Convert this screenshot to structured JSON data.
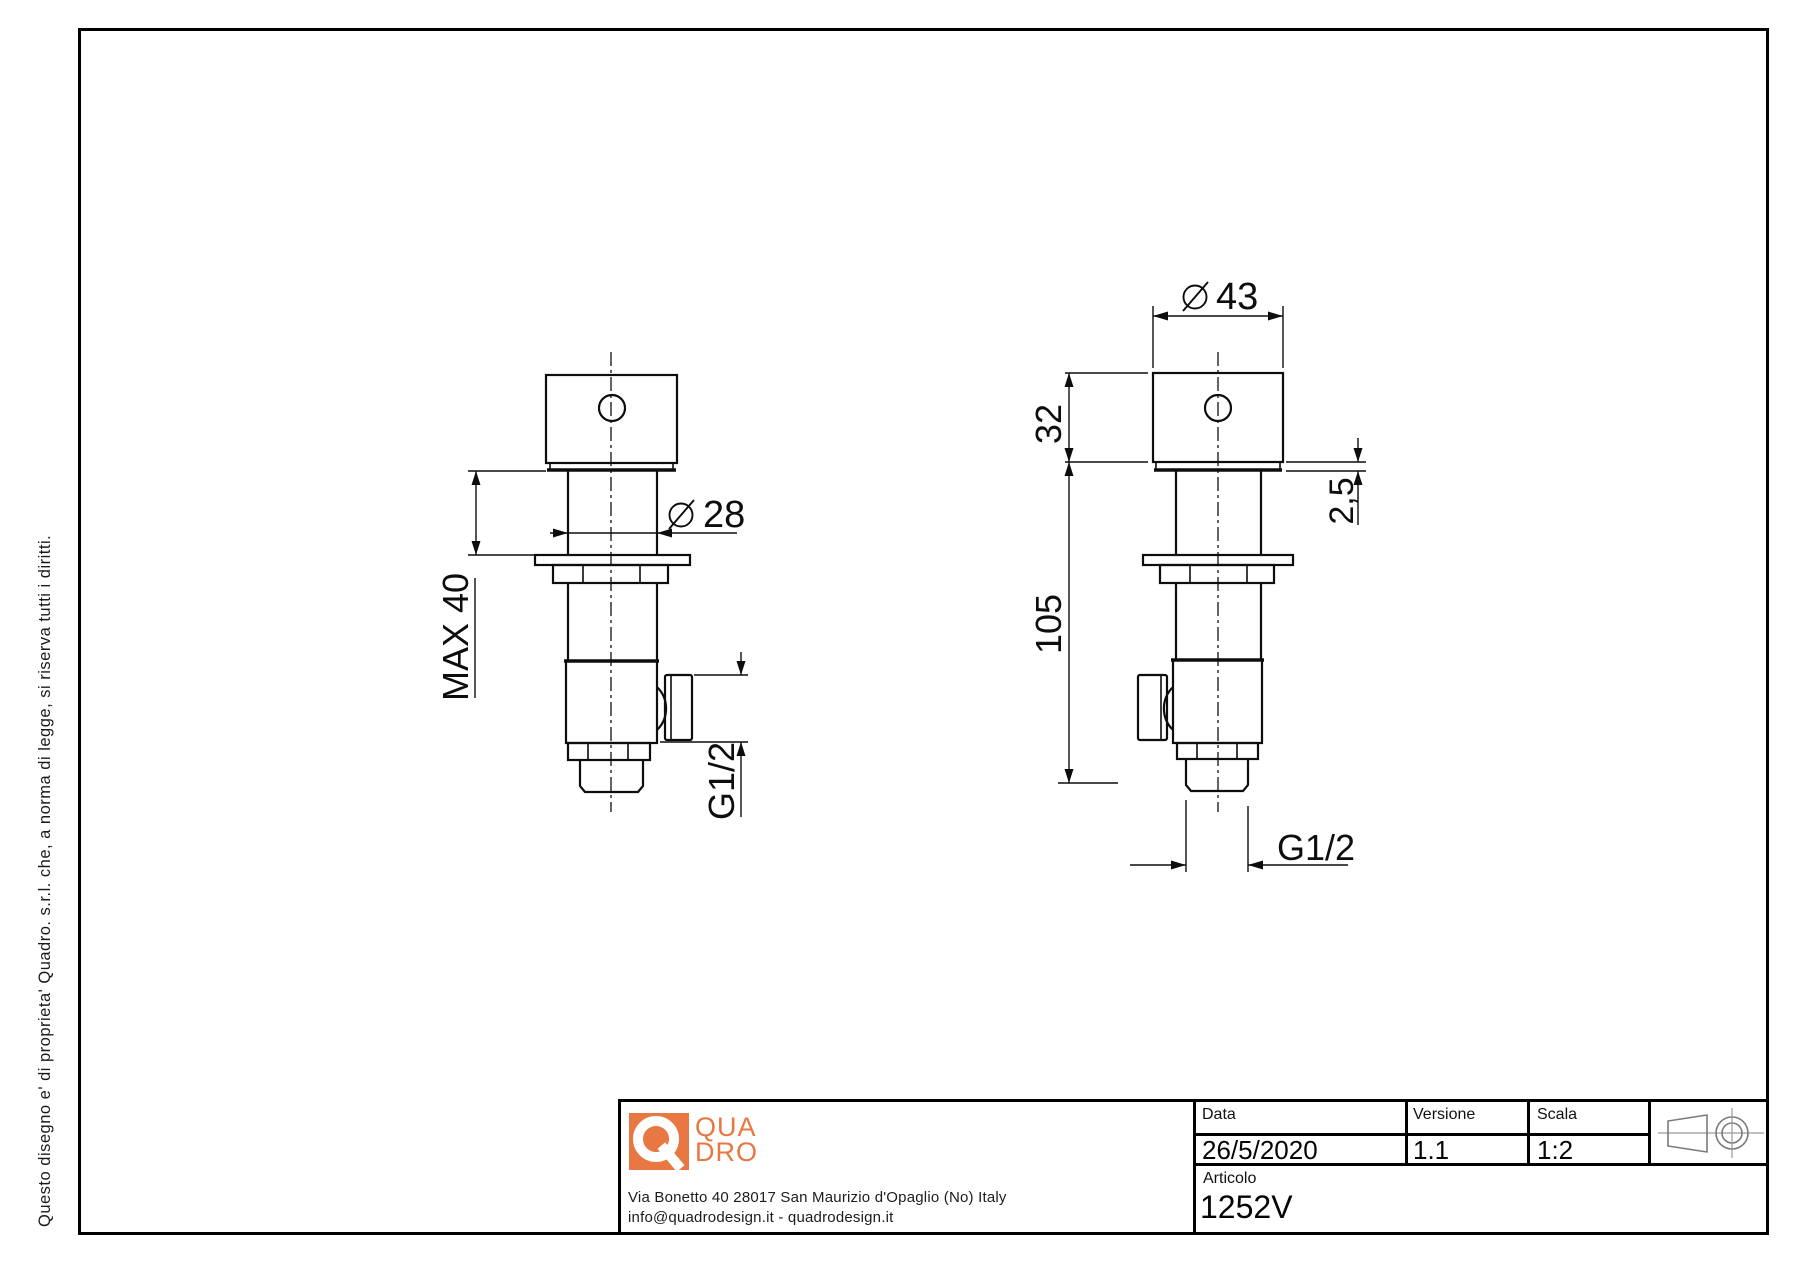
{
  "side_note": "Questo disegno e' di proprieta' Quadro. s.r.l. che, a norma di legge, si riserva tutti i diritti.",
  "figures": {
    "left_view": {
      "max_insertion": "MAX 40",
      "stem_diameter": {
        "symbol": "diameter",
        "value": "28"
      },
      "outlet_thread": "G1/2"
    },
    "right_view": {
      "handle_diameter": {
        "symbol": "diameter",
        "value": "43"
      },
      "handle_height": "32",
      "plate_thickness": "2,5",
      "body_height": "105",
      "tail_thread": "G1/2"
    }
  },
  "title_block": {
    "company": {
      "logo_line1": "QUA",
      "logo_line2": "DRO",
      "brand_color": "#e87741",
      "address_line1": "Via Bonetto 40  28017 San Maurizio d'Opaglio (No) Italy",
      "address_line2": "info@quadrodesign.it  -  quadrodesign.it"
    },
    "fields": {
      "data_label": "Data",
      "data_value": "26/5/2020",
      "versione_label": "Versione",
      "versione_value": "1.1",
      "scala_label": "Scala",
      "scala_value": "1:2",
      "articolo_label": "Articolo",
      "articolo_value": "1252V"
    },
    "projection_icon": "first-angle-projection"
  }
}
